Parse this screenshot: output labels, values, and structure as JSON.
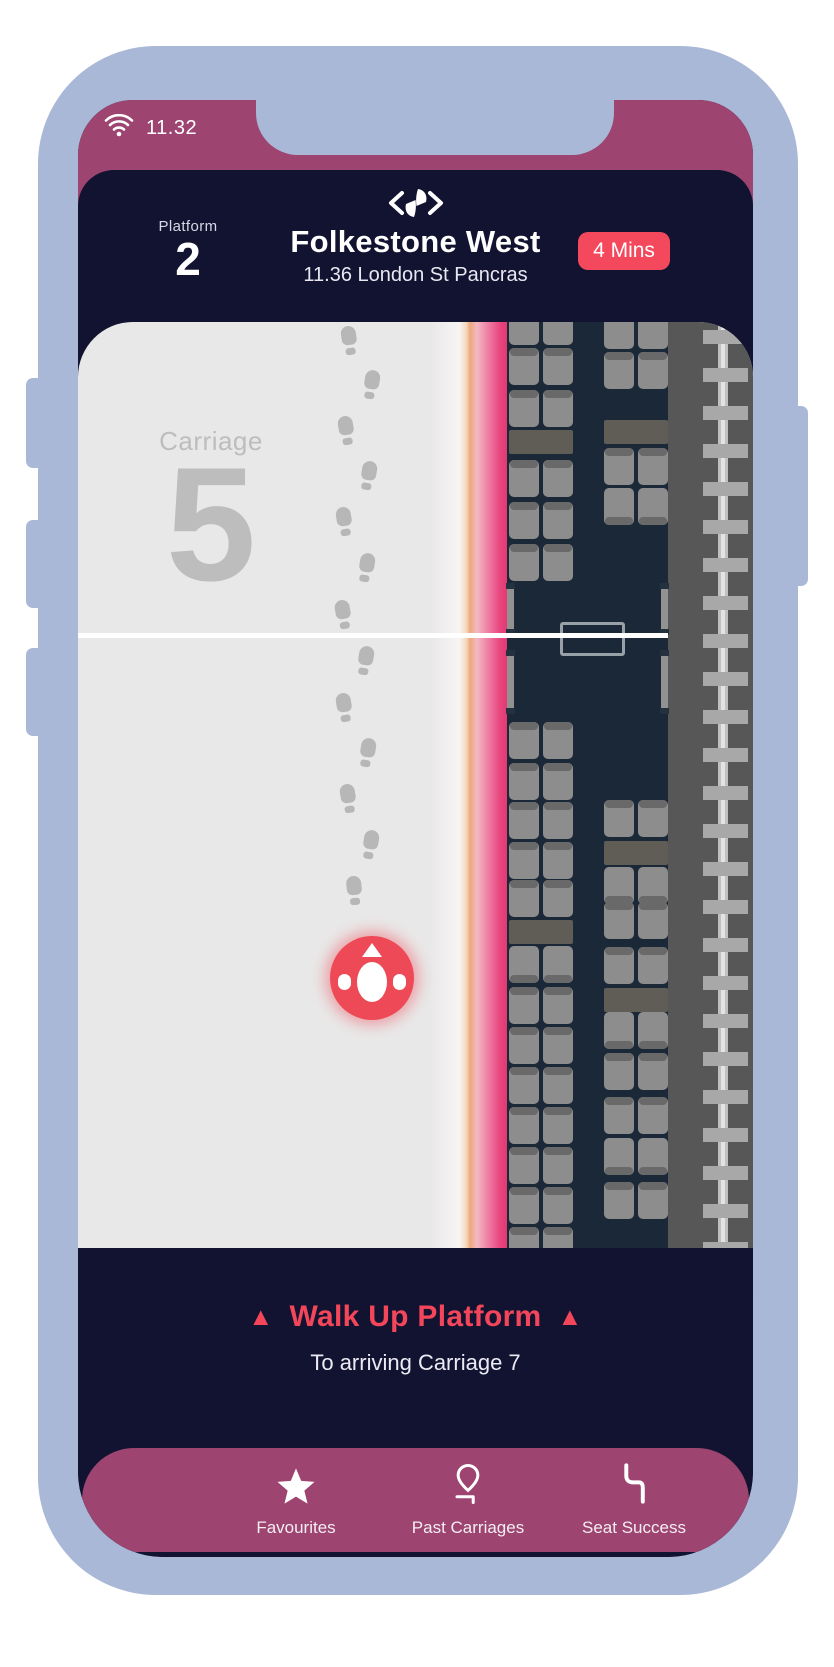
{
  "palette": {
    "frame": "#a9b8d7",
    "plum": "#9d4470",
    "navy": "#111330",
    "train_body": "#1b2838",
    "platform": "#e9e8e8",
    "accent_red": "#f4485c",
    "marker_red": "#ee4956",
    "edge_pink": "#e8437c",
    "edge_orange": "#eda87e",
    "seat_gray": "#8d8d8d"
  },
  "status_bar": {
    "time": "11.32",
    "wifi_icon": "wifi-icon"
  },
  "header": {
    "logo_icon": "eye-logo-icon",
    "platform_label": "Platform",
    "platform_number": "2",
    "station": "Folkestone West",
    "service": "11.36 London St Pancras",
    "eta": "4 Mins"
  },
  "map": {
    "carriage_label": "Carriage",
    "carriage_number": "5",
    "white_line_y": 311,
    "columns": {
      "L": 431,
      "R": 526
    },
    "seat_groups": [
      {
        "col": "L",
        "y": -14,
        "kind": "row",
        "dir": "down"
      },
      {
        "col": "L",
        "y": 26,
        "kind": "row",
        "dir": "down"
      },
      {
        "col": "L",
        "y": 68,
        "kind": "row",
        "dir": "down"
      },
      {
        "col": "L",
        "y": 108,
        "kind": "table"
      },
      {
        "col": "L",
        "y": 138,
        "kind": "row",
        "dir": "down"
      },
      {
        "col": "L",
        "y": 180,
        "kind": "row",
        "dir": "down"
      },
      {
        "col": "L",
        "y": 222,
        "kind": "row",
        "dir": "down"
      },
      {
        "col": "L",
        "y": 400,
        "kind": "row",
        "dir": "down"
      },
      {
        "col": "L",
        "y": 441,
        "kind": "row",
        "dir": "down"
      },
      {
        "col": "L",
        "y": 480,
        "kind": "row",
        "dir": "down"
      },
      {
        "col": "L",
        "y": 520,
        "kind": "row",
        "dir": "down"
      },
      {
        "col": "L",
        "y": 558,
        "kind": "row",
        "dir": "down"
      },
      {
        "col": "L",
        "y": 598,
        "kind": "table"
      },
      {
        "col": "L",
        "y": 624,
        "kind": "row",
        "dir": "up"
      },
      {
        "col": "L",
        "y": 665,
        "kind": "row",
        "dir": "down"
      },
      {
        "col": "L",
        "y": 705,
        "kind": "row",
        "dir": "down"
      },
      {
        "col": "L",
        "y": 745,
        "kind": "row",
        "dir": "down"
      },
      {
        "col": "L",
        "y": 785,
        "kind": "row",
        "dir": "down"
      },
      {
        "col": "L",
        "y": 825,
        "kind": "row",
        "dir": "down"
      },
      {
        "col": "L",
        "y": 865,
        "kind": "row",
        "dir": "down"
      },
      {
        "col": "L",
        "y": 905,
        "kind": "row",
        "dir": "down"
      },
      {
        "col": "R",
        "y": -10,
        "kind": "row",
        "dir": "down"
      },
      {
        "col": "R",
        "y": 30,
        "kind": "row",
        "dir": "down"
      },
      {
        "col": "R",
        "y": 98,
        "kind": "table"
      },
      {
        "col": "R",
        "y": 126,
        "kind": "row",
        "dir": "down"
      },
      {
        "col": "R",
        "y": 166,
        "kind": "row",
        "dir": "up"
      },
      {
        "col": "R",
        "y": 478,
        "kind": "row",
        "dir": "down"
      },
      {
        "col": "R",
        "y": 519,
        "kind": "table"
      },
      {
        "col": "R",
        "y": 545,
        "kind": "row",
        "dir": "up"
      },
      {
        "col": "R",
        "y": 580,
        "kind": "row",
        "dir": "down"
      },
      {
        "col": "R",
        "y": 625,
        "kind": "row",
        "dir": "down"
      },
      {
        "col": "R",
        "y": 666,
        "kind": "table"
      },
      {
        "col": "R",
        "y": 690,
        "kind": "row",
        "dir": "up"
      },
      {
        "col": "R",
        "y": 731,
        "kind": "row",
        "dir": "down"
      },
      {
        "col": "R",
        "y": 775,
        "kind": "row",
        "dir": "down"
      },
      {
        "col": "R",
        "y": 816,
        "kind": "row",
        "dir": "up"
      },
      {
        "col": "R",
        "y": 860,
        "kind": "row",
        "dir": "down"
      }
    ],
    "doors": [
      {
        "x": 429,
        "y": 263,
        "h": 48
      },
      {
        "x": 583,
        "y": 263,
        "h": 48
      },
      {
        "x": 429,
        "y": 330,
        "h": 60
      },
      {
        "x": 583,
        "y": 330,
        "h": 60
      }
    ],
    "footprints": [
      [
        263,
        4,
        -9
      ],
      [
        285,
        48,
        9
      ],
      [
        260,
        94,
        -9
      ],
      [
        282,
        139,
        9
      ],
      [
        258,
        185,
        -9
      ],
      [
        280,
        231,
        9
      ],
      [
        257,
        278,
        -10
      ],
      [
        279,
        324,
        9
      ],
      [
        258,
        371,
        -9
      ],
      [
        281,
        416,
        9
      ],
      [
        262,
        462,
        -9
      ],
      [
        284,
        508,
        9
      ],
      [
        268,
        554,
        -6
      ]
    ],
    "marker": {
      "x": 294,
      "y": 656
    },
    "sleepers": {
      "y0": 8,
      "step": 38,
      "count": 25
    }
  },
  "instruction": {
    "arrow": "▲",
    "title": "Walk Up Platform",
    "subtitle": "To arriving Carriage 7"
  },
  "nav": {
    "items": [
      {
        "icon": "star-icon",
        "label": "Favourites"
      },
      {
        "icon": "pin-icon",
        "label": "Past Carriages"
      },
      {
        "icon": "seat-icon",
        "label": "Seat Success"
      }
    ]
  }
}
